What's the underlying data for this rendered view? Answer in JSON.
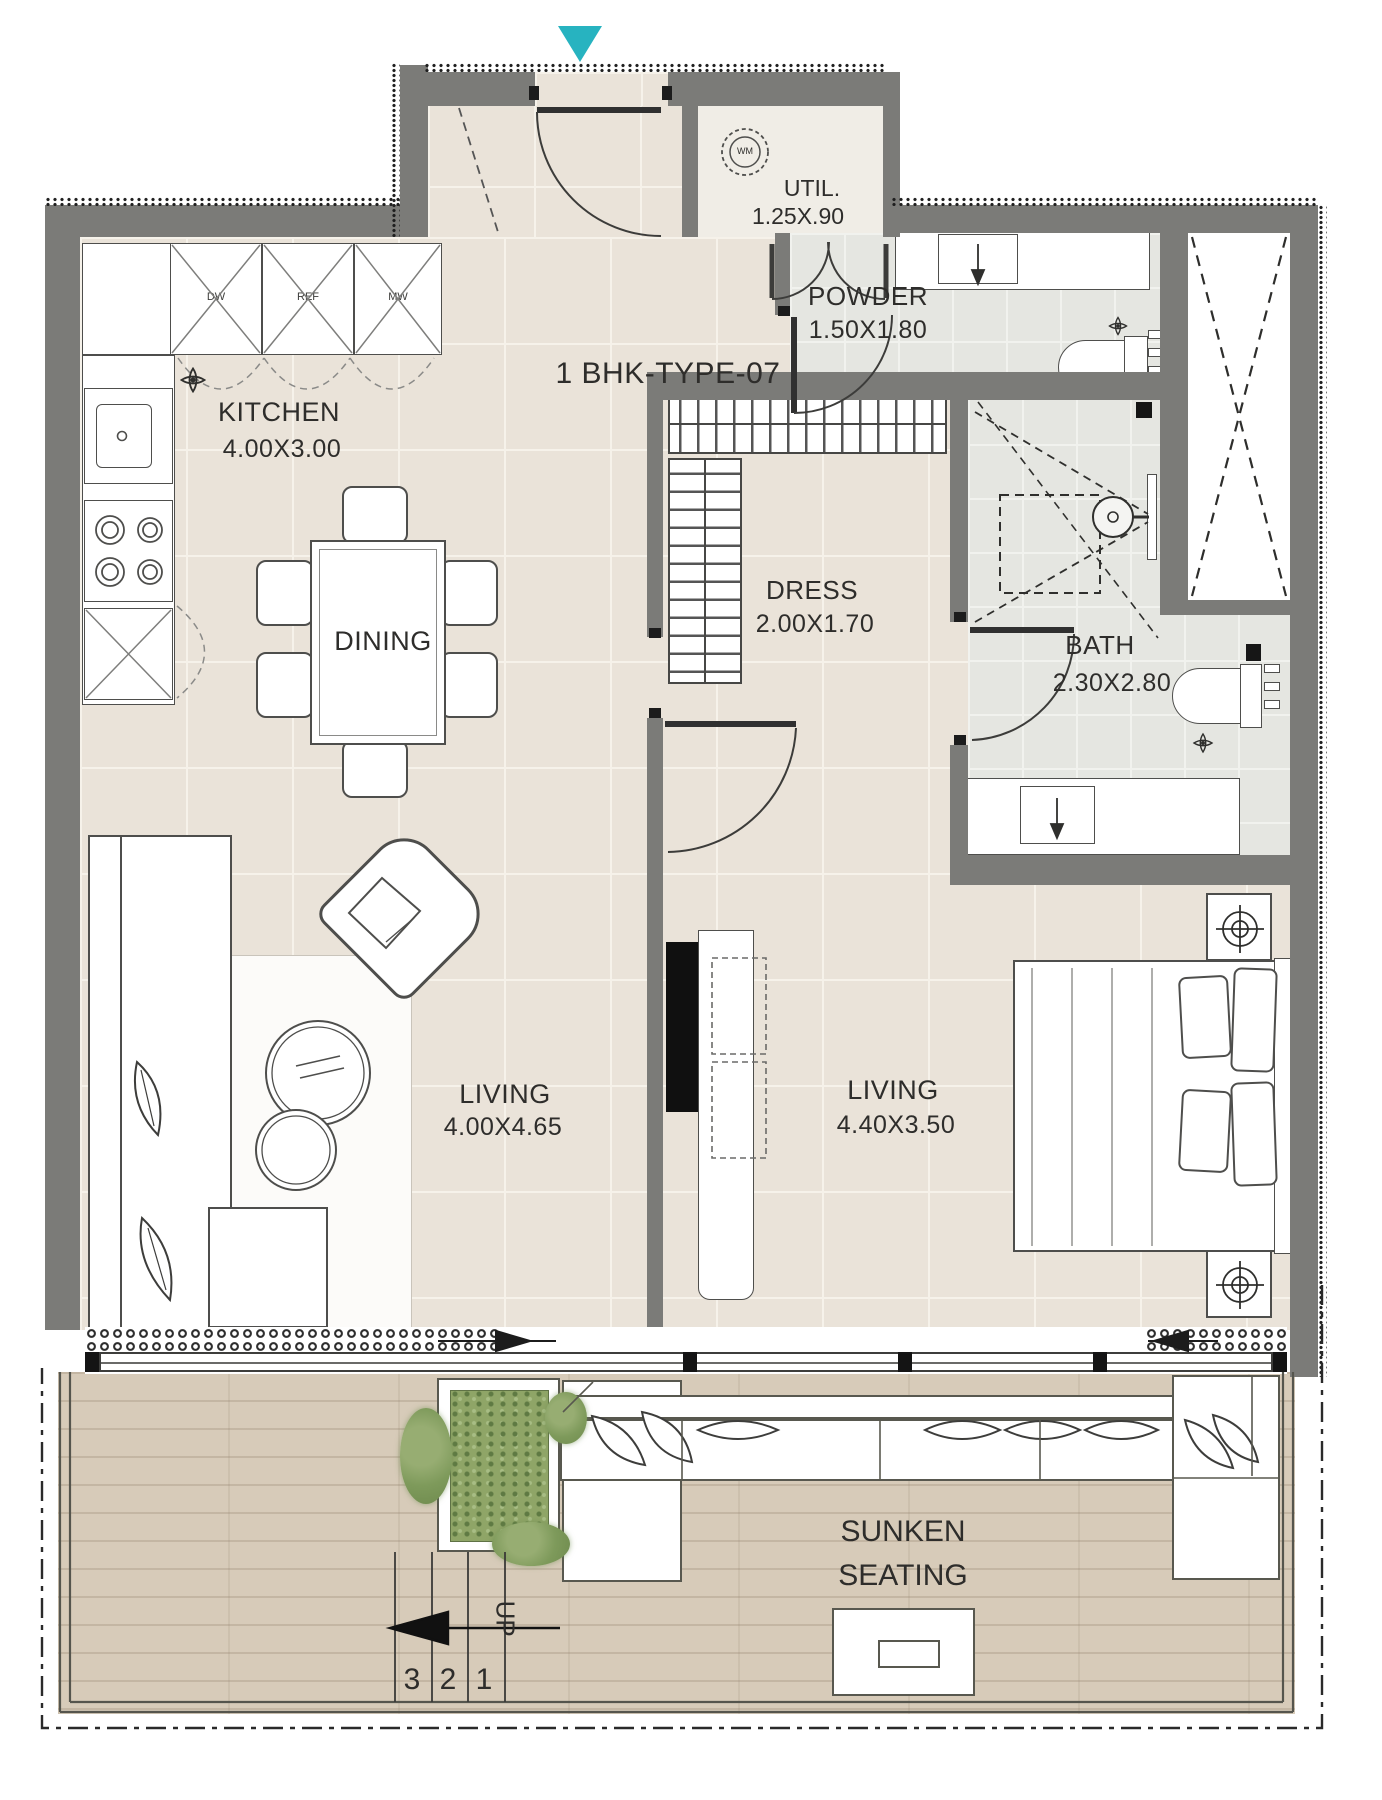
{
  "title": "1 BHK-TYPE-07",
  "rooms": {
    "kitchen": {
      "name": "KITCHEN",
      "dims": "4.00X3.00"
    },
    "dining": {
      "name": "DINING"
    },
    "utility": {
      "name": "UTIL.",
      "dims": "1.25X.90"
    },
    "powder": {
      "name": "POWDER",
      "dims": "1.50X1.80"
    },
    "dress": {
      "name": "DRESS",
      "dims": "2.00X1.70"
    },
    "bath": {
      "name": "BATH",
      "dims": "2.30X2.80"
    },
    "living": {
      "name": "LIVING",
      "dims": "4.00X4.65"
    },
    "bedroom_living": {
      "name": "LIVING",
      "dims": "4.40X3.50"
    },
    "sunken_seating": {
      "line1": "SUNKEN",
      "line2": "SEATING"
    }
  },
  "stairs": {
    "up_label": "UP",
    "treads": [
      "3",
      "2",
      "1"
    ]
  },
  "appliances": {
    "dishwasher": "DW",
    "refrigerator": "REF",
    "microwave": "MW",
    "washing_machine": "WM"
  },
  "colors": {
    "accent_teal": "#27b3c0",
    "wall_gray": "#7b7b78",
    "floor_tile": "#eae3d9",
    "wet_room_tile": "#e5e6e1",
    "balcony_wood": "#d7cbb9",
    "planter_green": "#8fa567"
  }
}
